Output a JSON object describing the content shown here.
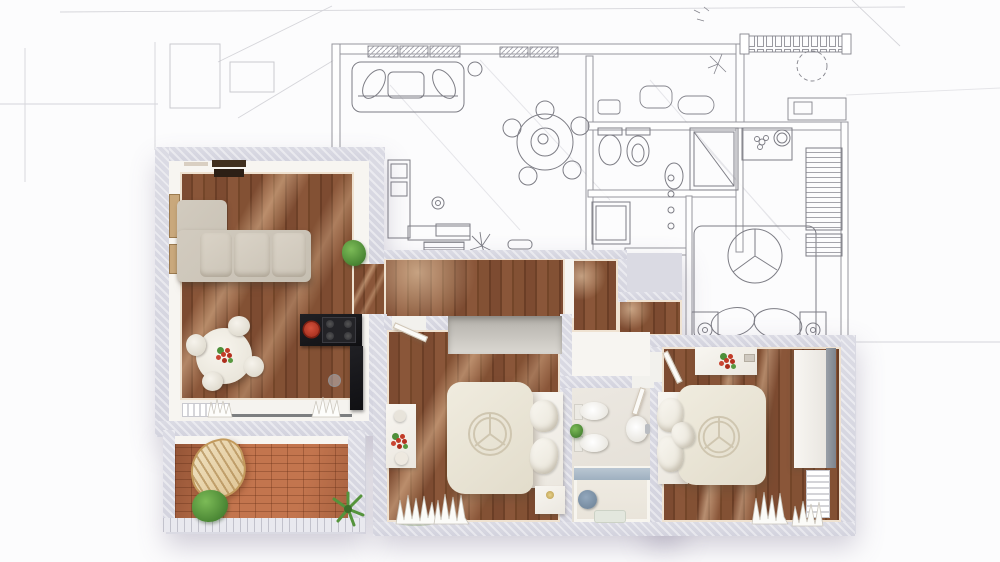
{
  "scene": {
    "description": "Top-down apartment floor plan; lower-left half is a photorealistic 3D render with furniture, upper-right half is a pencil sketch line drawing of the same apartment",
    "render_style": "3D rendered top view",
    "sketch_style": "pencil line drawing"
  },
  "palette": {
    "background": "#fcfcfd",
    "wall": "#d9d9e2",
    "wall_face": "#f7f5f1",
    "wood_floor": "#7d4b31",
    "wood_highlight": "#ffdbb2",
    "terrace_tile": "#c3754e",
    "sofa": "#cfc8bc",
    "bed_linen": "#eae6da",
    "kitchen_counter": "#17171a",
    "accent_red": "#b93425",
    "plant_green": "#5a9a42",
    "bath_blue": "#8ea3b8",
    "rattan": "#ead9b6",
    "sketch_line": "#84848c"
  },
  "rooms": {
    "rendered": [
      {
        "id": "living-dining-kitchen",
        "furniture": [
          "l-shaped-sofa",
          "tv-sideboard",
          "wall-shelves",
          "round-dining-table",
          "four-chairs",
          "flower-centerpiece",
          "black-kitchen-counter",
          "gas-cooktop",
          "red-pan",
          "potted-plant",
          "radiator",
          "glass-door",
          "sill-plants"
        ]
      },
      {
        "id": "terrace",
        "furniture": [
          "rattan-lounge-chair",
          "bush",
          "palm-plant",
          "terracotta-tile-floor",
          "railing"
        ]
      },
      {
        "id": "hallway",
        "furniture": []
      },
      {
        "id": "bedroom-1",
        "furniture": [
          "double-bed",
          "circle-stitch-duvet",
          "pillows",
          "vanity-desk",
          "red-flowers",
          "closet-niche",
          "nightstand",
          "sheer-curtains",
          "open-door"
        ]
      },
      {
        "id": "bathroom",
        "furniture": [
          "toilet",
          "bidet",
          "washbasin",
          "bathtub",
          "blue-stool",
          "small-plant",
          "bath-mat"
        ]
      },
      {
        "id": "bedroom-2",
        "furniture": [
          "double-bed",
          "circle-stitch-duvet",
          "pillows",
          "desk",
          "red-flowers",
          "wardrobe",
          "radiator",
          "sheer-curtains",
          "open-door"
        ]
      }
    ],
    "sketched": [
      {
        "id": "living-room-sketch",
        "furniture": [
          "sofa-with-cushions",
          "floor-lamp",
          "round-table",
          "five-chairs",
          "l-shaped-kitchen-counter",
          "sink",
          "radiator",
          "plant",
          "bench",
          "hatched-windows"
        ]
      },
      {
        "id": "bathroom-sketch",
        "furniture": [
          "toilet",
          "bidet",
          "washbasin",
          "shower-cabin"
        ]
      },
      {
        "id": "bedroom-sketch",
        "furniture": [
          "double-bed",
          "round-duvet-motif",
          "pillows",
          "two-nightstands",
          "lamps",
          "hatched-wardrobe",
          "dresser",
          "round-mirror",
          "flower-scribble"
        ]
      },
      {
        "id": "balcony-sketch",
        "furniture": [
          "crenellated-railing",
          "tree",
          "sun-symbol",
          "desk"
        ]
      },
      {
        "id": "entry-sketch",
        "furniture": [
          "arched-threshold"
        ]
      }
    ]
  }
}
